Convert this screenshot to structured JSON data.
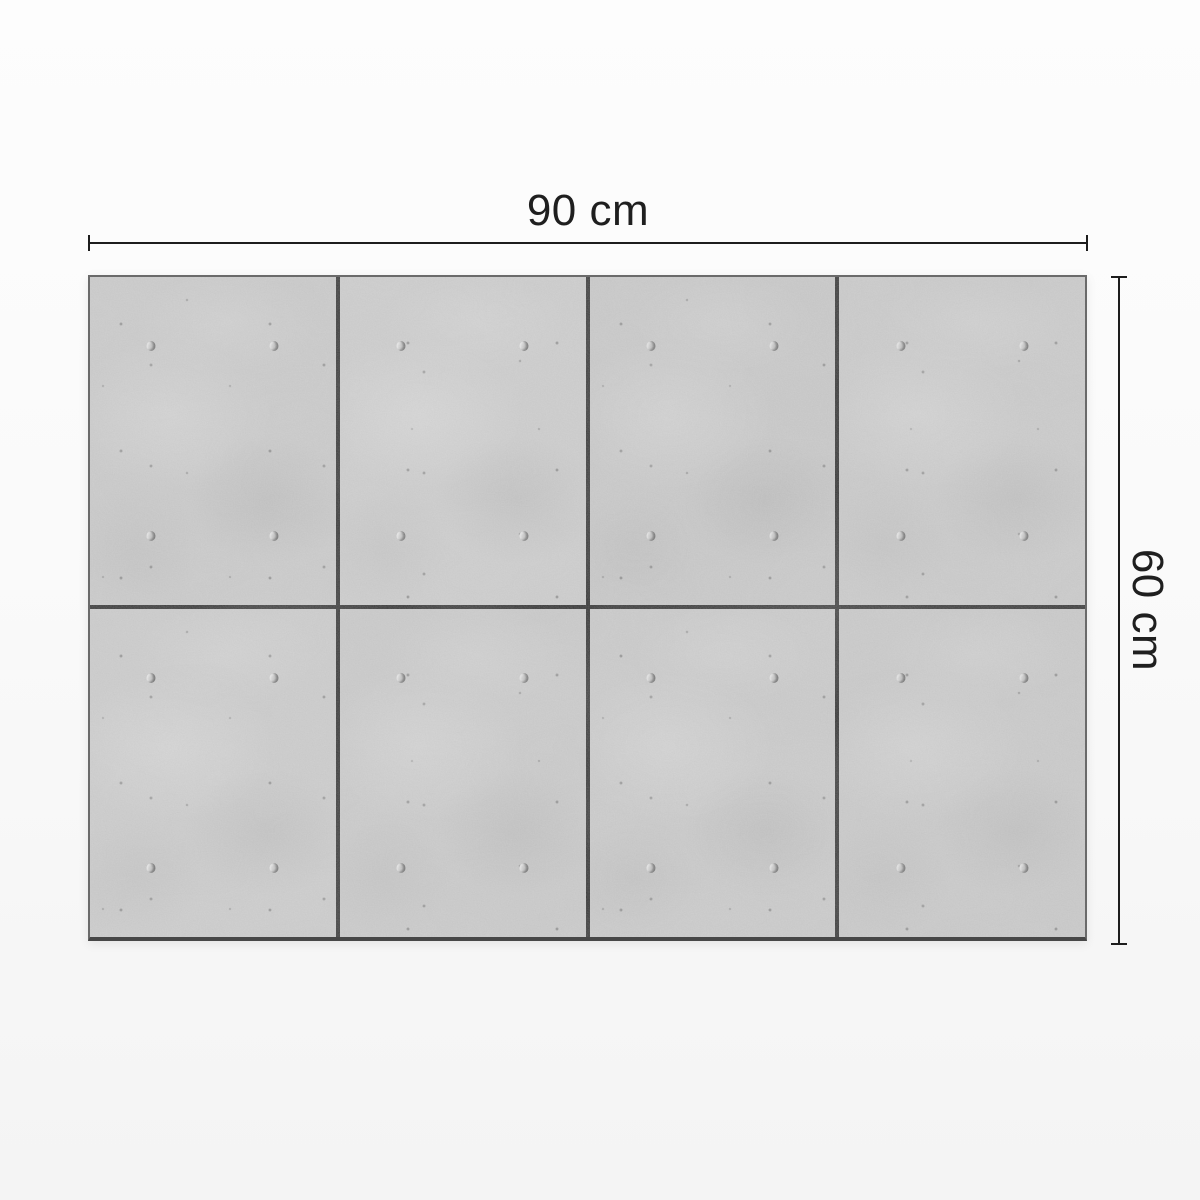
{
  "dimensions": {
    "width_label": "90 cm",
    "height_label": "60 cm"
  },
  "panel": {
    "name": "concrete tile panel",
    "rows": 2,
    "cols": 4,
    "tile_count": 8,
    "tie_holes_per_tile": 4,
    "hole_positions_pct": [
      [
        25,
        21
      ],
      [
        75,
        21
      ],
      [
        25,
        79
      ],
      [
        75,
        79
      ]
    ]
  },
  "colors": {
    "concrete_base": "#c8c8c8",
    "seam": "#2e2e2e",
    "dimension_line": "#1d1d1d",
    "label_text": "#1f1f1f",
    "background_top": "#fdfdfd",
    "background_bottom": "#f4f4f4"
  }
}
